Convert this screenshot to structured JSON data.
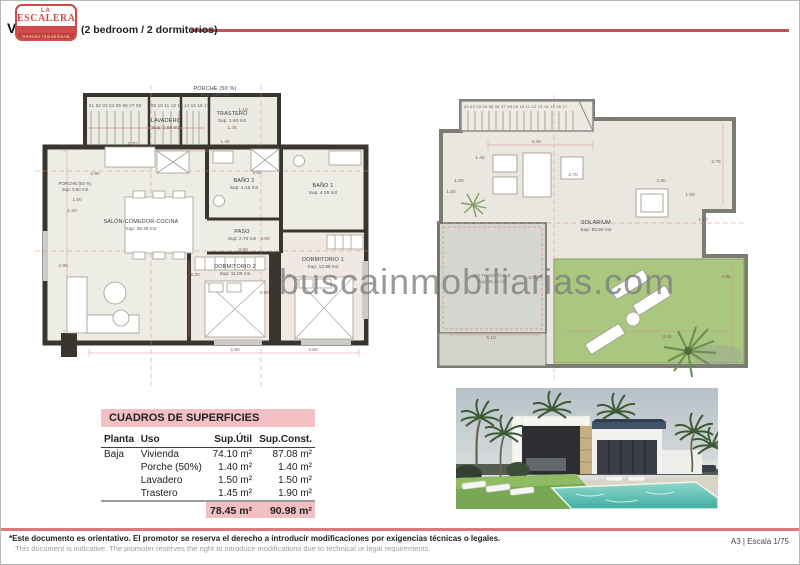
{
  "header": {
    "logo": {
      "top": "LA",
      "name": "ESCALERA",
      "tagline": "Gestión Inmobiliaria"
    },
    "title_prefix": "VILLA A",
    "title_suffix": "(2 bedroom / 2 dormitorios)"
  },
  "watermark": "buscainmobiliarias.com",
  "ground_plan": {
    "stairs_row1": "01 02 03 04 05 06 07 08",
    "stairs_row2": "09 10 11 12 13",
    "stairs_row3": "14 15 16 17",
    "rooms": {
      "porche_top": {
        "name": "PORCHE (50 %)",
        "sup": "Sup: 3.50 m2"
      },
      "lavadero": {
        "name": "LAVADERO",
        "sup": "Sup: 1.50 m2"
      },
      "trastero": {
        "name": "TRASTERO",
        "sup": "Sup: 1.90 m2"
      },
      "porche_left": {
        "name": "PORCHE (50 %)",
        "sup": "Sup: 0.90 m2"
      },
      "salon": {
        "name": "SALÓN-COMEDOR-COCINA",
        "sup": "Sup: 38.25 m2"
      },
      "bano2": {
        "name": "BAÑO 2",
        "sup": "Sup: 4.15 m2"
      },
      "bano1": {
        "name": "BAÑO 1",
        "sup": "Sup: 4.05 m2"
      },
      "paso": {
        "name": "PASO",
        "sup": "Sup: 2.70 m2"
      },
      "dormitorio2": {
        "name": "DORMITORIO 2",
        "sup": "Sup: 11.00 m2"
      },
      "dormitorio1": {
        "name": "DORMITORIO 1",
        "sup": "Sup: 13.95 m2"
      }
    },
    "dims": [
      "4.30",
      "2.60",
      "2.90",
      "1.50",
      "1.20",
      "4.95",
      "5.20",
      "3.00",
      "3.90",
      "4.80",
      "2.90",
      "2.80",
      "1.45",
      "1.19",
      "1.40",
      "0.90"
    ]
  },
  "roof_plan": {
    "stairs": "01 02 03 04 05 06 07 08 09 10 11 12 13 14 15 16 17",
    "rooms": {
      "solarium": {
        "name": "SOLARIUM",
        "sup": "Sup: 53.50 m2"
      },
      "no_transitable": {
        "name": "NO TRANSITABLE",
        "sup": "Sup: 25.75 m2"
      }
    },
    "dims": [
      "1.67",
      "2.75",
      "4.28",
      "1.40",
      "2.70",
      "1.00",
      "1.50",
      "3.90",
      "1.50",
      "1.10",
      "4.85",
      "3.35",
      "5.10",
      "5.05"
    ]
  },
  "table": {
    "title": "CUADROS DE SUPERFICIES",
    "headers": [
      "Planta",
      "Uso",
      "Sup.Útil",
      "Sup.Const."
    ],
    "rows": [
      {
        "planta": "Baja",
        "uso": "Vivienda",
        "util": "74.10 m²",
        "const": "87.08 m²"
      },
      {
        "planta": "",
        "uso": "Porche (50%)",
        "util": "1.40 m²",
        "const": "1.40 m²"
      },
      {
        "planta": "",
        "uso": "Lavadero",
        "util": "1.50 m²",
        "const": "1.50 m²"
      },
      {
        "planta": "",
        "uso": "Trastero",
        "util": "1.45 m²",
        "const": "1.90 m²"
      }
    ],
    "total_util": "78.45 m²",
    "total_const": "90.98 m²"
  },
  "footer": {
    "disclaimer_es": "*Este documento es orientativo. El promotor se reserva el derecho a introducir modificaciones por exigencias técnicas o legales.",
    "disclaimer_en": "This document is indicative. The promoter reserves the right to introduce modifications due to technical or legal requirements.",
    "sheet": "A3 | Escala 1/75"
  },
  "colors": {
    "accent_red": "#cf4a4a",
    "pink_band": "#f2bfc3",
    "dim_line": "#d98c8c",
    "wall_dark": "#3a352f",
    "grass": "#a9c77f",
    "pool": "#5cc2b2"
  }
}
